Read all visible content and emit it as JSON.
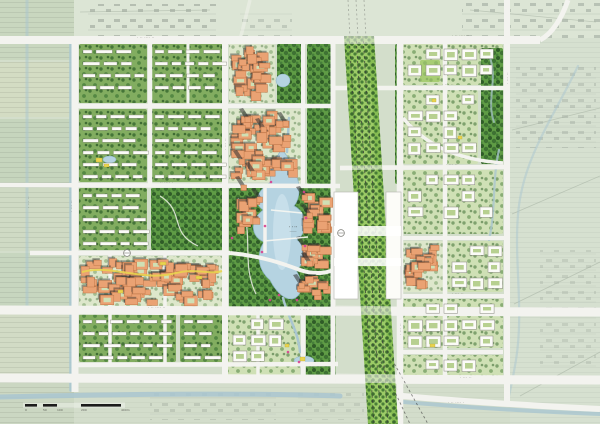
{
  "map": {
    "palette": {
      "bg": "#d3decb",
      "road": "#f3f3ef",
      "res_ground": "#82ad60",
      "park_ground": "#5f9c45",
      "campus_ground": "#cfe0b5",
      "cbd_ground": "#dde7cb",
      "lawn": "#a8cd74",
      "rail_green": "#86bd52",
      "rail_light": "#9ccb66",
      "track": "#3a3a3a",
      "water": "#b5d3e1",
      "water_light": "#cfe4ee",
      "canal": "#a9c6d0",
      "orange": "#eaa273",
      "orange_dark": "#c2794a",
      "shadow": "#2f2f2f",
      "white_building": "#fbfbf7",
      "building_stroke": "#88887f",
      "yellow": "#e9d44f",
      "pink": "#d8408f",
      "label": "#54544c",
      "sketch_line": "#a7b2a3",
      "scale_black": "#1c1c1c"
    },
    "underlay": [
      {
        "x": 0,
        "y": 0,
        "w": 74,
        "h": 60,
        "f": "#c9d7bf",
        "p": "pHatch"
      },
      {
        "x": 0,
        "y": 62,
        "w": 74,
        "h": 55,
        "f": "#d3dcc3",
        "p": "pHatch"
      },
      {
        "x": 0,
        "y": 119,
        "w": 74,
        "h": 64,
        "f": "#c6d5bd",
        "p": "pHatch"
      },
      {
        "x": 0,
        "y": 185,
        "w": 74,
        "h": 66,
        "f": "#cfdac4",
        "p": "pHatch"
      },
      {
        "x": 0,
        "y": 253,
        "w": 74,
        "h": 55,
        "f": "#c7d6bf",
        "p": "pHatch"
      },
      {
        "x": 0,
        "y": 310,
        "w": 74,
        "h": 66,
        "f": "#d2dbc5",
        "p": "pHatch"
      },
      {
        "x": 0,
        "y": 378,
        "w": 74,
        "h": 46,
        "f": "#cbd7c2",
        "p": "pHatch"
      },
      {
        "x": 74,
        "y": 0,
        "w": 526,
        "h": 38,
        "f": "#dce5d5"
      },
      {
        "x": 510,
        "y": 38,
        "w": 90,
        "h": 386,
        "f": "#d6e0d0",
        "p": "pHatch",
        "op": 0.45
      },
      {
        "x": 74,
        "y": 382,
        "w": 436,
        "h": 42,
        "f": "#d3ddcb",
        "p": "pHatch",
        "op": 0.35
      },
      {
        "x": 88,
        "y": 4,
        "w": 128,
        "h": 32,
        "p": "pScrib",
        "op": 0.5
      },
      {
        "x": 462,
        "y": 0,
        "w": 138,
        "h": 38,
        "p": "pScrib",
        "op": 0.45
      },
      {
        "x": 240,
        "y": 12,
        "w": 52,
        "h": 24,
        "p": "pScrib",
        "op": 0.35
      },
      {
        "x": 516,
        "y": 64,
        "w": 80,
        "h": 84,
        "p": "pScrib",
        "op": 0.32
      },
      {
        "x": 540,
        "y": 250,
        "w": 56,
        "h": 120,
        "p": "pScrib",
        "op": 0.25
      },
      {
        "x": 150,
        "y": 390,
        "w": 126,
        "h": 30,
        "p": "pScrib",
        "op": 0.3
      },
      {
        "x": 298,
        "y": 392,
        "w": 66,
        "h": 28,
        "p": "pScrib",
        "op": 0.25
      }
    ],
    "underlay_paths": [
      {
        "d": "M512,130 L600,108"
      },
      {
        "d": "M512,214 L600,176"
      },
      {
        "d": "M514,304 L600,262"
      },
      {
        "d": "M520,396 L600,352"
      },
      {
        "d": "M80,12 L210,10"
      },
      {
        "d": "M470,10 L596,22"
      }
    ],
    "blocks": [
      {
        "x": 79,
        "y": 44,
        "w": 68,
        "h": 59,
        "t": "res"
      },
      {
        "x": 151,
        "y": 44,
        "w": 74,
        "h": 59,
        "t": "res"
      },
      {
        "x": 229,
        "y": 44,
        "w": 46,
        "h": 59,
        "t": "cbd"
      },
      {
        "x": 277,
        "y": 44,
        "w": 26,
        "h": 59,
        "t": "park"
      },
      {
        "x": 307,
        "y": 44,
        "w": 24,
        "h": 140,
        "t": "park"
      },
      {
        "x": 395,
        "y": 44,
        "w": 8,
        "h": 140,
        "t": "park"
      },
      {
        "x": 79,
        "y": 109,
        "w": 68,
        "h": 73,
        "t": "res"
      },
      {
        "x": 151,
        "y": 109,
        "w": 74,
        "h": 73,
        "t": "res"
      },
      {
        "x": 229,
        "y": 109,
        "w": 72,
        "h": 73,
        "t": "cbd"
      },
      {
        "x": 79,
        "y": 188,
        "w": 68,
        "h": 62,
        "t": "res"
      },
      {
        "x": 151,
        "y": 188,
        "w": 72,
        "h": 62,
        "t": "park",
        "path": "M160,196 C186,212 168,232 198,246"
      },
      {
        "x": 229,
        "y": 188,
        "w": 106,
        "h": 120,
        "t": "park",
        "path": "M238,198 C256,230 240,262 256,294"
      },
      {
        "x": 79,
        "y": 256,
        "w": 144,
        "h": 52,
        "t": "cbd"
      },
      {
        "x": 79,
        "y": 314,
        "w": 97,
        "h": 48,
        "t": "res"
      },
      {
        "x": 180,
        "y": 314,
        "w": 43,
        "h": 48,
        "t": "res"
      },
      {
        "x": 228,
        "y": 314,
        "w": 72,
        "h": 62,
        "t": "campus"
      },
      {
        "x": 306,
        "y": 314,
        "w": 30,
        "h": 62,
        "t": "park"
      },
      {
        "x": 403,
        "y": 44,
        "w": 100,
        "h": 41,
        "t": "campus"
      },
      {
        "x": 420,
        "y": 60,
        "w": 20,
        "h": 22,
        "t": "lawn"
      },
      {
        "x": 403,
        "y": 90,
        "w": 75,
        "h": 74,
        "t": "campus"
      },
      {
        "x": 481,
        "y": 48,
        "w": 22,
        "h": 116,
        "t": "park"
      },
      {
        "x": 403,
        "y": 170,
        "w": 100,
        "h": 64,
        "t": "campus"
      },
      {
        "x": 403,
        "y": 241,
        "w": 40,
        "h": 51,
        "t": "cbd"
      },
      {
        "x": 447,
        "y": 241,
        "w": 56,
        "h": 51,
        "t": "campus"
      },
      {
        "x": 403,
        "y": 299,
        "w": 100,
        "h": 49,
        "t": "campus"
      },
      {
        "x": 403,
        "y": 355,
        "w": 100,
        "h": 21,
        "t": "campus"
      },
      {
        "x": 233,
        "y": 190,
        "w": 30,
        "h": 46,
        "t": "bldgO"
      },
      {
        "x": 299,
        "y": 190,
        "w": 36,
        "h": 46,
        "t": "bldgO"
      },
      {
        "x": 299,
        "y": 240,
        "w": 36,
        "h": 32,
        "t": "bldgO"
      },
      {
        "x": 295,
        "y": 274,
        "w": 40,
        "h": 30,
        "t": "bldgO"
      }
    ],
    "water": {
      "lake": "M281,150 C275,160 268,170 271,182 C258,190 252,202 263,210 C250,220 250,236 264,242 C256,254 258,270 270,280 C276,292 286,302 295,298 C304,293 302,280 296,270 C307,262 306,246 297,240 C309,231 307,212 294,206 C302,196 300,178 292,168 C289,160 286,152 281,150 Z",
      "lake_highlight": {
        "cx": 282,
        "cy": 232,
        "rx": 9,
        "ry": 38
      },
      "streams": [
        {
          "d": "M289,118 L287,152",
          "w": 2.5
        },
        {
          "d": "M283,298 C288,318 298,330 300,352",
          "w": 2.5
        },
        {
          "d": "M499,150 C492,180 496,210 489,240",
          "w": 2.2,
          "op": 0.8
        },
        {
          "d": "M490,58 C498,80 486,100 494,122",
          "w": 2,
          "op": 0.7
        },
        {
          "d": "M0,397 C120,394 250,393 340,396",
          "w": 5,
          "op": 0.85
        },
        {
          "d": "M380,400 C460,407 545,412 600,414",
          "w": 4,
          "op": 0.8
        },
        {
          "d": "M578,66 C552,120 522,160 518,215 C514,262 524,310 516,360 C512,384 509,395 508,401",
          "w": 2.2,
          "op": 0.5
        },
        {
          "d": "M27,0 L27,312",
          "w": 3,
          "op": 0.5
        },
        {
          "d": "M71,42 L71,390",
          "w": 3.5,
          "op": 0.9
        }
      ],
      "ponds": [
        [
          276,
          74,
          14,
          13
        ],
        [
          103,
          156,
          13,
          7
        ],
        [
          294,
          356,
          20,
          9
        ]
      ]
    },
    "roads": [
      {
        "d": "M0,40 L540,40",
        "w": 8
      },
      {
        "d": "M540,40 C552,34 562,18 568,0",
        "w": 5
      },
      {
        "d": "M0,310 L600,312",
        "w": 9
      },
      {
        "d": "M0,378 L600,380",
        "w": 9
      },
      {
        "d": "M75,40 L75,392",
        "w": 7
      },
      {
        "d": "M507,0 L507,402",
        "w": 6
      },
      {
        "d": "M400,40 L400,424",
        "w": 6.5
      },
      {
        "d": "M333,40 L333,380",
        "w": 5
      },
      {
        "d": "M225,40 L225,380",
        "w": 6
      },
      {
        "d": "M150,40 L150,187",
        "w": 4.5
      },
      {
        "d": "M75,106 L333,106",
        "w": 4.5
      },
      {
        "d": "M333,88 L507,88",
        "w": 4.5
      },
      {
        "d": "M0,185 L340,186",
        "w": 4.5
      },
      {
        "d": "M340,168 L507,167",
        "w": 4.5
      },
      {
        "d": "M30,253 L230,253",
        "w": 4.5
      },
      {
        "d": "M230,253 C262,256 284,264 300,270 C318,276 330,272 338,268",
        "w": 4
      },
      {
        "d": "M400,238 L507,238",
        "w": 4
      },
      {
        "d": "M400,296 L507,296",
        "w": 4
      },
      {
        "d": "M403,352 L503,352",
        "w": 4
      },
      {
        "d": "M75,365 L338,364",
        "w": 4.5
      },
      {
        "d": "M110,253 L110,365",
        "w": 3.5
      },
      {
        "d": "M165,253 L165,365",
        "w": 3.5
      },
      {
        "d": "M265,186 L265,253",
        "w": 3.5
      },
      {
        "d": "M303,40 L303,186",
        "w": 4
      },
      {
        "d": "M303,312 L303,378",
        "w": 4
      },
      {
        "d": "M445,44 L445,378",
        "w": 4.5
      },
      {
        "d": "M403,118 C428,148 462,160 503,163",
        "w": 3.5
      },
      {
        "d": "M382,394 C450,401 540,406 600,409",
        "w": 6
      },
      {
        "d": "M250,0 L240,40",
        "w": 3.5,
        "op": 0.45
      },
      {
        "d": "M188,44 L188,106",
        "w": 3
      },
      {
        "d": "M258,312 L258,378",
        "w": 3.5
      }
    ],
    "roads_over_rail": [
      {
        "d": "M336,310 L404,311",
        "w": 9
      },
      {
        "d": "M336,378 L404,379",
        "w": 9
      },
      {
        "d": "M340,168 L404,167",
        "w": 4.5
      },
      {
        "d": "M336,40 L380,40",
        "w": 8
      }
    ],
    "rail": {
      "corridor": "344,36 374,36 398,424 368,424",
      "inner": "350,36 368,36 392,424 374,424",
      "tracks": [
        [
          349,
          36,
          374,
          424
        ],
        [
          356,
          36,
          381,
          424
        ],
        [
          363,
          36,
          388,
          424
        ]
      ],
      "fan": [
        [
          370,
          320,
          428,
          424
        ],
        [
          366,
          330,
          410,
          424
        ]
      ],
      "faint": [
        [
          348,
          0,
          350,
          38
        ],
        [
          356,
          0,
          358,
          38
        ],
        [
          364,
          0,
          366,
          38
        ]
      ]
    },
    "station": {
      "west": [
        334,
        192,
        24,
        107
      ],
      "east": [
        386,
        192,
        15,
        107
      ],
      "decks": [
        [
          334,
          226,
          67,
          10
        ],
        [
          334,
          258,
          67,
          8
        ]
      ]
    },
    "towers": [
      [
        246,
        118
      ],
      [
        262,
        128
      ],
      [
        284,
        122
      ],
      [
        240,
        160
      ],
      [
        252,
        172
      ],
      [
        242,
        186
      ],
      [
        258,
        198
      ],
      [
        303,
        196
      ],
      [
        308,
        214
      ],
      [
        303,
        246
      ],
      [
        308,
        262
      ],
      [
        300,
        284
      ]
    ],
    "accents": {
      "yellow_rects": [
        [
          96,
          158,
          6,
          4
        ],
        [
          104,
          164,
          5,
          3
        ],
        [
          432,
          99,
          4,
          3
        ],
        [
          458,
          136,
          4,
          3
        ],
        [
          300,
          357,
          5,
          4
        ],
        [
          285,
          344,
          4,
          3
        ],
        [
          430,
          344,
          5,
          3
        ],
        [
          160,
          262,
          6,
          3
        ],
        [
          196,
          276,
          6,
          3
        ],
        [
          118,
          290,
          5,
          3
        ]
      ],
      "pink_dots": [
        [
          271,
          182
        ],
        [
          304,
          192
        ],
        [
          265,
          226
        ],
        [
          305,
          246
        ],
        [
          279,
          295
        ],
        [
          297,
          300
        ],
        [
          262,
          252
        ],
        [
          306,
          218
        ],
        [
          299,
          362
        ],
        [
          288,
          352
        ],
        [
          232,
          238
        ],
        [
          270,
          300
        ]
      ],
      "yellow_path": "M82,272 C112,264 142,282 176,273 C196,268 210,275 222,271",
      "bridges": [
        "M264,241 L308,237",
        "M271,210 L302,213"
      ],
      "roundabouts": [
        [
          127,
          253
        ],
        [
          341,
          233
        ]
      ]
    },
    "labels": [
      {
        "x": 137,
        "y": 39,
        "t": "· ·· ···· ··"
      },
      {
        "x": 452,
        "y": 37,
        "t": "· ·· ···· ··"
      },
      {
        "x": 170,
        "y": 104,
        "t": "·· ···· ·"
      },
      {
        "x": 160,
        "y": 184,
        "t": "·· ···· ·"
      },
      {
        "x": 442,
        "y": 86,
        "t": "· ··· ··"
      },
      {
        "x": 446,
        "y": 166,
        "t": "· ··· ··"
      },
      {
        "x": 140,
        "y": 251,
        "t": "· ··· ··"
      },
      {
        "x": 148,
        "y": 309,
        "t": "· ·· ···· ··"
      },
      {
        "x": 452,
        "y": 295,
        "t": "· ··· ··"
      },
      {
        "x": 135,
        "y": 363,
        "t": "·· ···· ·"
      },
      {
        "x": 460,
        "y": 379,
        "t": "· ··· ··"
      },
      {
        "x": 300,
        "y": 311,
        "t": "· ··· ··"
      },
      {
        "x": 448,
        "y": 404,
        "t": "· ·· ···· ·"
      },
      {
        "x": 73,
        "y": 212,
        "t": "· ··· ··",
        "r": -90
      },
      {
        "x": 30,
        "y": 208,
        "t": "· ··· ··",
        "r": -90
      },
      {
        "x": 491,
        "y": 206,
        "t": "· ··· ··",
        "r": -90
      },
      {
        "x": 509,
        "y": 84,
        "t": "· ··· ··",
        "r": -90
      },
      {
        "x": 402,
        "y": 335,
        "t": "· ··· ··",
        "r": -90
      },
      {
        "x": 227,
        "y": 150,
        "t": "· ··· ··",
        "r": -90
      }
    ],
    "lake_label": {
      "x": 293,
      "y": 228,
      "line1": "· · ··",
      "line2": "·······"
    },
    "scale_bar": {
      "x": 25,
      "y": 404,
      "h": 2.6,
      "segments": [
        [
          0,
          12
        ],
        [
          18,
          14
        ],
        [
          56,
          40
        ]
      ],
      "labels": [
        [
          "0",
          0
        ],
        [
          "50",
          18
        ],
        [
          "100",
          32
        ],
        [
          "200",
          56
        ],
        [
          "400m",
          96
        ]
      ]
    }
  }
}
